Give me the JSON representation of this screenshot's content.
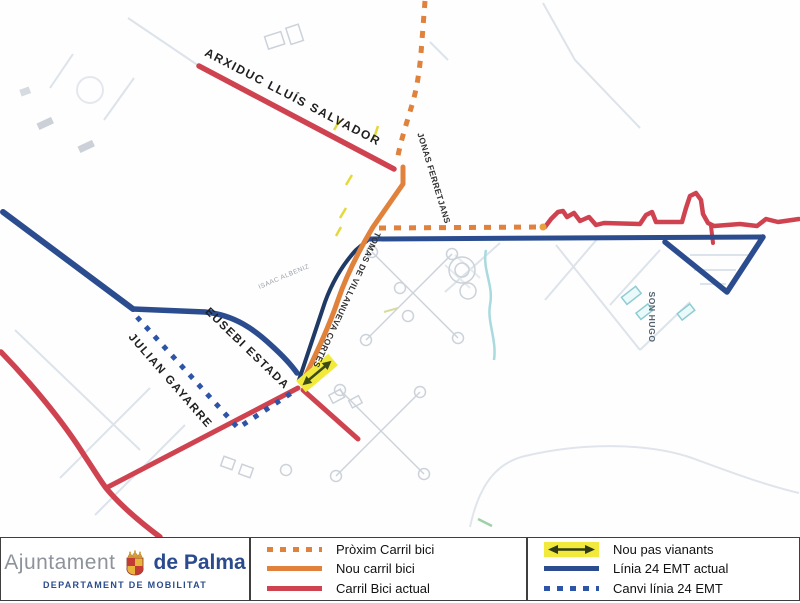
{
  "map": {
    "street_labels": [
      {
        "id": "arxiduc",
        "text": "ARXIDUC LLUÍS SALVADOR"
      },
      {
        "id": "jonas",
        "text": "JONAS FERRETJANS"
      },
      {
        "id": "tomas",
        "text": "TOMAS DE VILLANUEVA CORTES"
      },
      {
        "id": "eusebi",
        "text": "EUSEBI ESTADA"
      },
      {
        "id": "julian",
        "text": "JULIAN GAYARRE"
      },
      {
        "id": "isaac",
        "text": "ISAAC ALBENIZ"
      },
      {
        "id": "son_hugo",
        "text": "SON HUGO"
      }
    ],
    "colors": {
      "carril_bici_actual": "#cf4350",
      "nou_carril_bici": "#e0813c",
      "proxim_carril_bici": "#e0813c",
      "linia_24_actual": "#2b4d8f",
      "canvi_linia_24": "#2d55a7",
      "nou_pas_vianants": "#f2e93d",
      "background_streets": "#dde3ea"
    }
  },
  "legend": {
    "bike_items": [
      {
        "label": "Pròxim Carril bici",
        "swatch": "orange-dashed"
      },
      {
        "label": "Nou carril bici",
        "swatch": "orange-solid"
      },
      {
        "label": "Carril Bici actual",
        "swatch": "red-solid"
      }
    ],
    "transit_items": [
      {
        "label": "Nou pas vianants",
        "swatch": "yellow-arrow"
      },
      {
        "label": "Línia 24 EMT actual",
        "swatch": "blue-solid"
      },
      {
        "label": "Canvi línia 24 EMT",
        "swatch": "blue-dashed"
      }
    ]
  },
  "logo": {
    "municipality_light": "Ajuntament",
    "municipality_bold": "de Palma",
    "department": "DEPARTAMENT DE MOBILITAT"
  }
}
